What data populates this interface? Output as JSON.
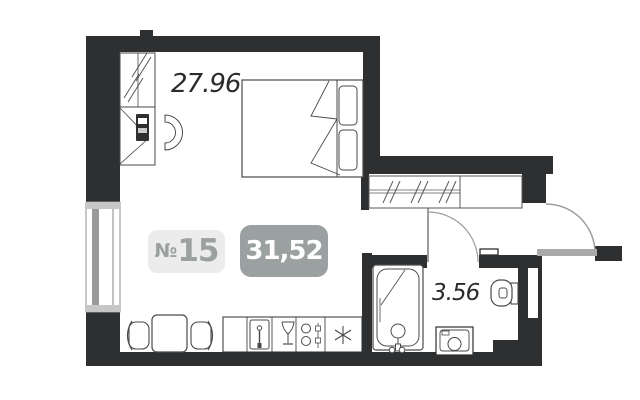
{
  "plan": {
    "unit": {
      "prefix": "№",
      "number": "15"
    },
    "total_area": "31,52",
    "areas": {
      "living_room": "27.96",
      "bathroom": "3.56"
    },
    "colors": {
      "wall": "#2e2f30",
      "furniture_line": "#4a4a4a",
      "door_gray": "#9d9d9d",
      "window_gray": "#9a9a9a",
      "badge_light_bg": "#ebeceb",
      "badge_gray_bg": "#9ba0a1",
      "badge_gray_text": "#9ba0a1",
      "badge_white_text": "#ffffff",
      "area_text": "#2b2b2b",
      "background": "#ffffff"
    },
    "furniture": [
      "wardrobe-mirror",
      "desk",
      "laptop",
      "desk-chair",
      "double-bed",
      "pillows",
      "hall-closet",
      "entrance-door",
      "bathroom-door",
      "bathtub",
      "toilet",
      "washing-machine",
      "dining-table",
      "dining-chairs",
      "kitchen-sink",
      "glass",
      "stove",
      "refrigerator-asterisk",
      "window"
    ]
  }
}
